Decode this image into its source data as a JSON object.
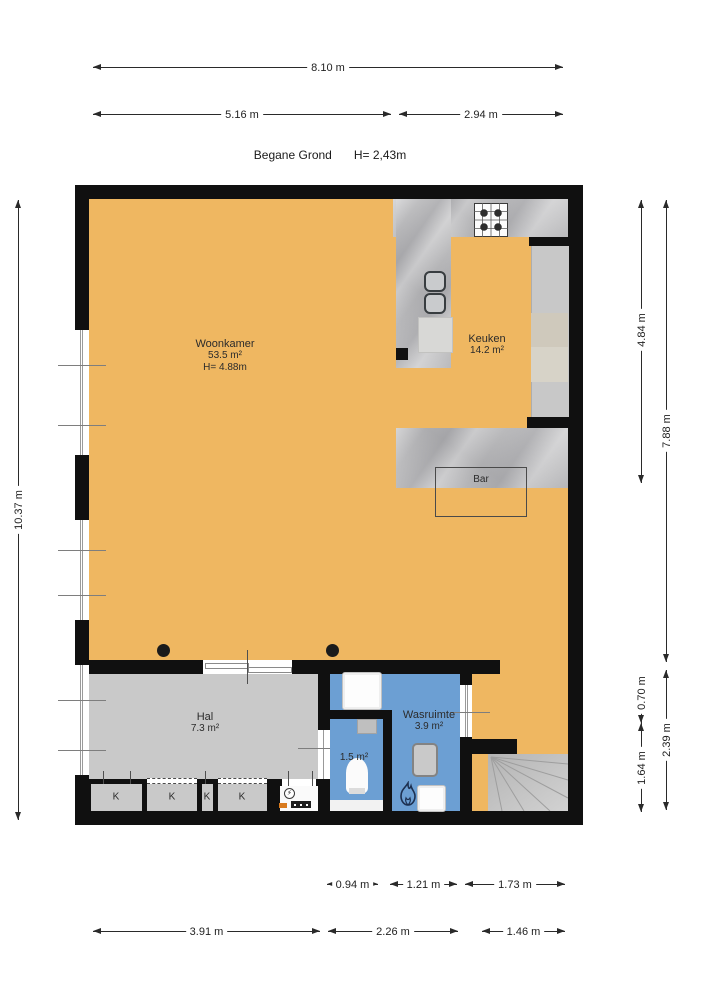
{
  "title": {
    "name": "Begane Grond",
    "height": "H= 2,43m"
  },
  "dimensions": {
    "top_total": "8.10 m",
    "top_left": "5.16 m",
    "top_right": "2.94 m",
    "left_total": "10.37 m",
    "right_inner_top": "4.84 m",
    "right_inner_mid": "0.70 m",
    "right_inner_bottom": "1.64 m",
    "right_outer_top": "7.88 m",
    "right_outer_bottom": "2.39 m",
    "bottom_upper_1": "0.94 m",
    "bottom_upper_2": "1.21 m",
    "bottom_upper_3": "1.73 m",
    "bottom_lower_1": "3.91 m",
    "bottom_lower_2": "2.26 m",
    "bottom_lower_3": "1.46 m"
  },
  "rooms": {
    "woonkamer": {
      "name": "Woonkamer",
      "area": "53.5 m²",
      "ceiling": "H= 4.88m"
    },
    "keuken": {
      "name": "Keuken",
      "area": "14.2 m²"
    },
    "hal": {
      "name": "Hal",
      "area": "7.3 m²"
    },
    "toilet": {
      "area": "1.5 m²"
    },
    "wasruimte": {
      "name": "Wasruimte",
      "area": "3.9 m²"
    },
    "bar": {
      "name": "Bar"
    },
    "closets": {
      "k1": "K",
      "k2": "K",
      "k3": "K",
      "k4": "K"
    }
  },
  "icons": {
    "electricity": "⚡"
  },
  "colors": {
    "floor": "#EFB761",
    "hall_floor": "#C9C9C9",
    "wet_floor": "#6C9FD3",
    "counter": "#B5B5B7",
    "wall": "#101010"
  }
}
